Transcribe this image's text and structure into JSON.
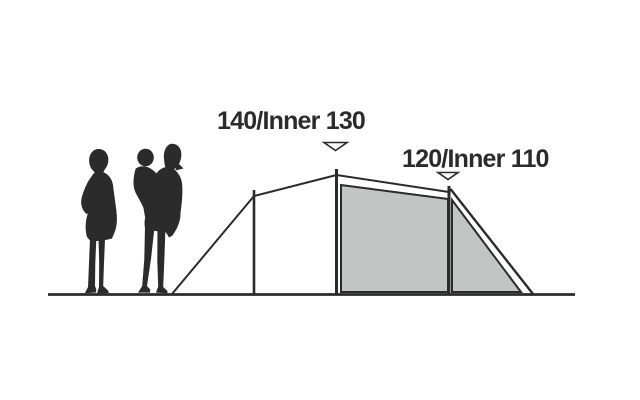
{
  "diagram": {
    "type": "tent-height-profile",
    "labels": {
      "peak_height": "140/Inner 130",
      "rear_height": "120/Inner 110"
    },
    "colors": {
      "ink": "#2b2b2b",
      "inner_tent_fill": "#c3c4c4",
      "background": "#ffffff"
    },
    "icons": [
      "adult-silhouette",
      "adult-with-child-silhouette",
      "height-marker-triangle-icon"
    ]
  }
}
